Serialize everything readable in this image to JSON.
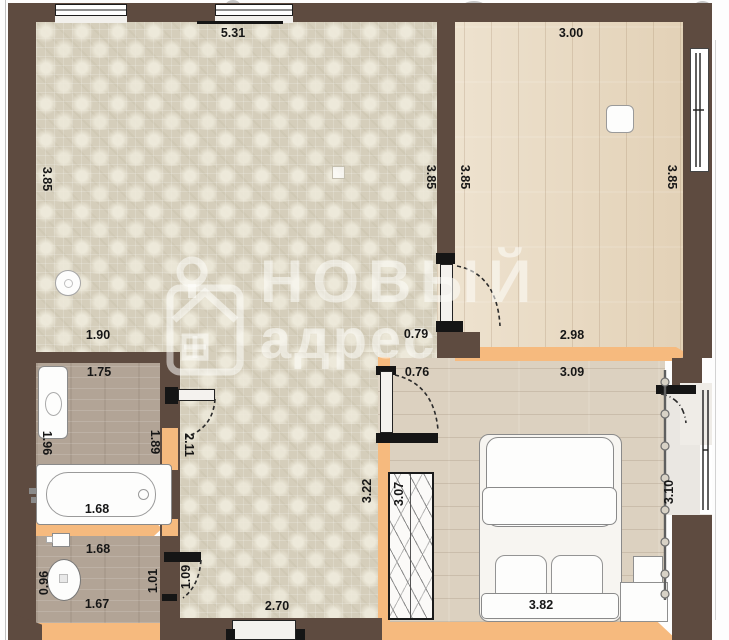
{
  "watermark": {
    "line1": "НОВЫЙ",
    "line2": "адрес"
  },
  "dims": {
    "living_top": "5.31",
    "living_left": "3.85",
    "living_right": "3.85",
    "living_opening": "1.90",
    "kitchen_top": "3.00",
    "kitchen_left": "3.85",
    "kitchen_right": "3.85",
    "kitchen_door": "0.79",
    "bedroom_outer_top": "2.98",
    "bedroom_top": "3.09",
    "bedroom_bottom": "3.82",
    "bedroom_right": "3.10",
    "bedroom_door": "0.76",
    "bedroom_left": "3.22",
    "wardrobe": "3.07",
    "bath_top": "1.75",
    "bath_left": "1.96",
    "bath_right": "1.89",
    "bathtub": "1.68",
    "wc_top": "1.68",
    "wc_bottom": "1.67",
    "wc_left": "0.96",
    "wc_right": "1.01",
    "wc_door": "1.09",
    "hall_bottom": "2.70",
    "hall_side": "2.11"
  },
  "colors": {
    "load_bearing_wall": "#5e4b40",
    "partition_wall": "#f6ba7e",
    "living_floor": "#d5cebb",
    "kitchen_floor": "#e9dac1",
    "bedroom_floor": "#dcd1c0",
    "bath_floor": "#b2a496",
    "balcony_floor": "#eae7e2",
    "dimension_text": "#161616"
  }
}
